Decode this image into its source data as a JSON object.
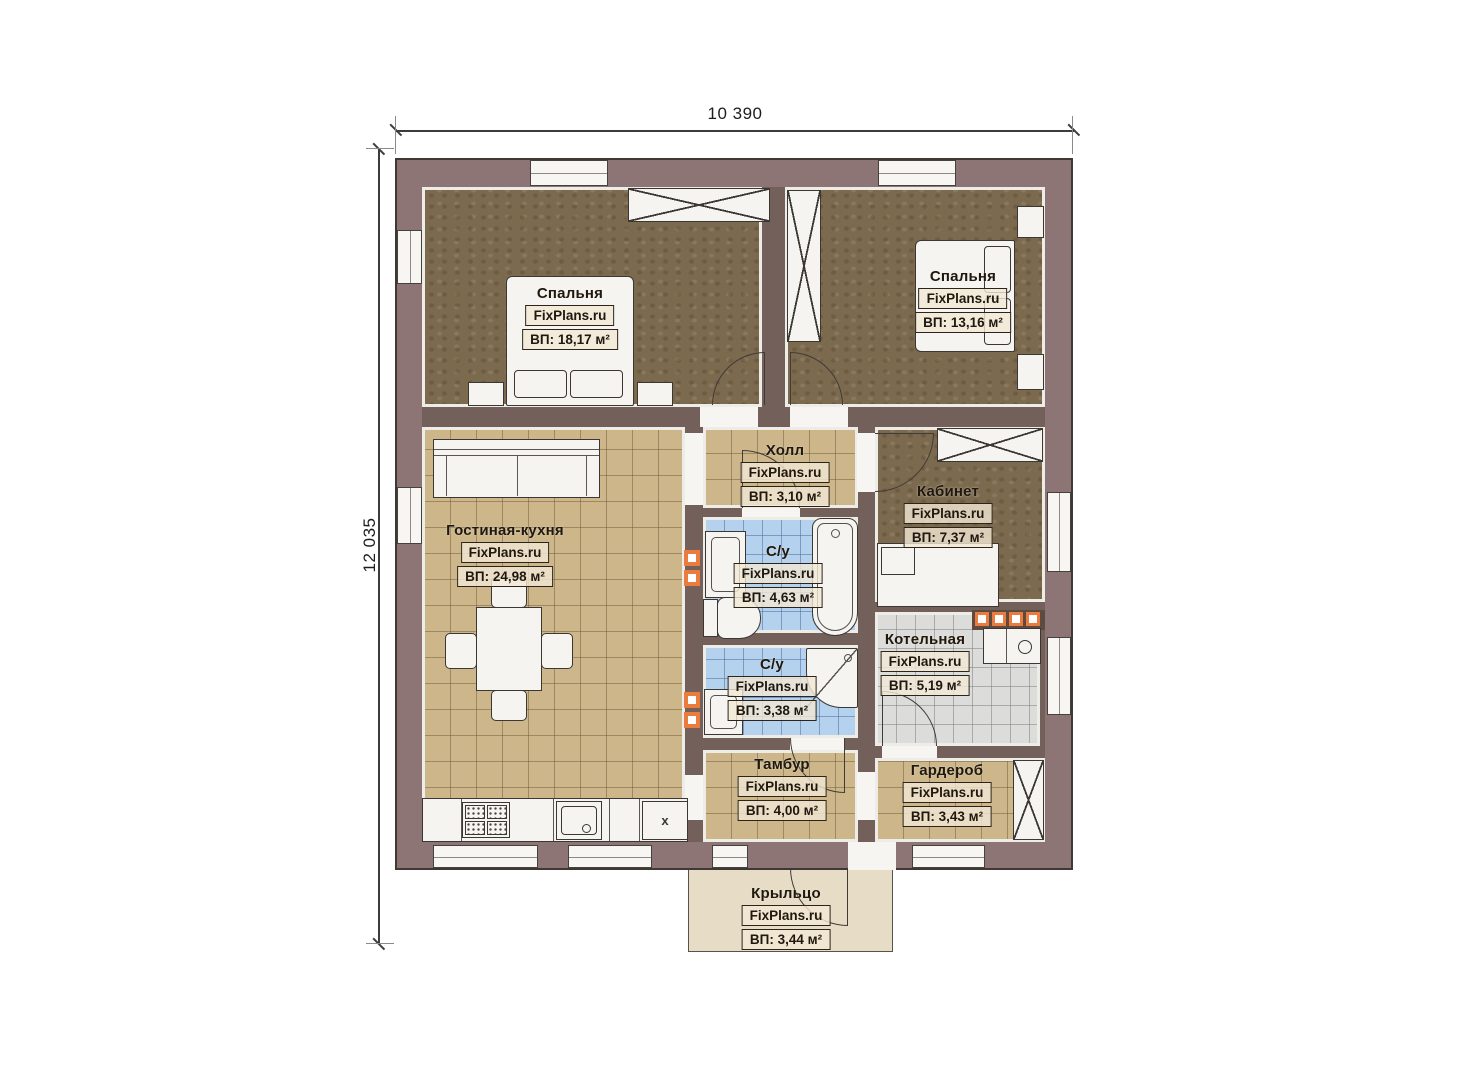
{
  "dimensions": {
    "top": "10 390",
    "side": "12 035"
  },
  "rooms": [
    {
      "id": "bedroom-1",
      "name": "Спальня",
      "brand": "FixPlans.ru",
      "area": "ВП: 18,17 м²"
    },
    {
      "id": "bedroom-2",
      "name": "Спальня",
      "brand": "FixPlans.ru",
      "area": "ВП: 13,16 м²"
    },
    {
      "id": "hall",
      "name": "Холл",
      "brand": "FixPlans.ru",
      "area": "ВП: 3,10 м²"
    },
    {
      "id": "study",
      "name": "Кабинет",
      "brand": "FixPlans.ru",
      "area": "ВП: 7,37 м²"
    },
    {
      "id": "living",
      "name": "Гостиная-кухня",
      "brand": "FixPlans.ru",
      "area": "ВП: 24,98 м²"
    },
    {
      "id": "bath-1",
      "name": "С/у",
      "brand": "FixPlans.ru",
      "area": "ВП: 4,63 м²"
    },
    {
      "id": "bath-2",
      "name": "С/у",
      "brand": "FixPlans.ru",
      "area": "ВП: 3,38 м²"
    },
    {
      "id": "boiler",
      "name": "Котельная",
      "brand": "FixPlans.ru",
      "area": "ВП: 5,19 м²"
    },
    {
      "id": "tambour",
      "name": "Тамбур",
      "brand": "FixPlans.ru",
      "area": "ВП: 4,00 м²"
    },
    {
      "id": "wardrobe",
      "name": "Гардероб",
      "brand": "FixPlans.ru",
      "area": "ВП: 3,43 м²"
    },
    {
      "id": "porch",
      "name": "Крыльцо",
      "brand": "FixPlans.ru",
      "area": "ВП: 3,44 м²"
    }
  ],
  "kitchen": {
    "x_label": "x"
  },
  "colors": {
    "wall": "#8d7576",
    "partition": "#73605a",
    "bedroom_floor": "#7c6a4f",
    "tile_tan": "#ccb68a",
    "tile_blue": "#b4d1ee",
    "tile_gray": "#dcdcda",
    "porch": "#e7ddc7",
    "radiator_accent": "#e97c3e"
  }
}
